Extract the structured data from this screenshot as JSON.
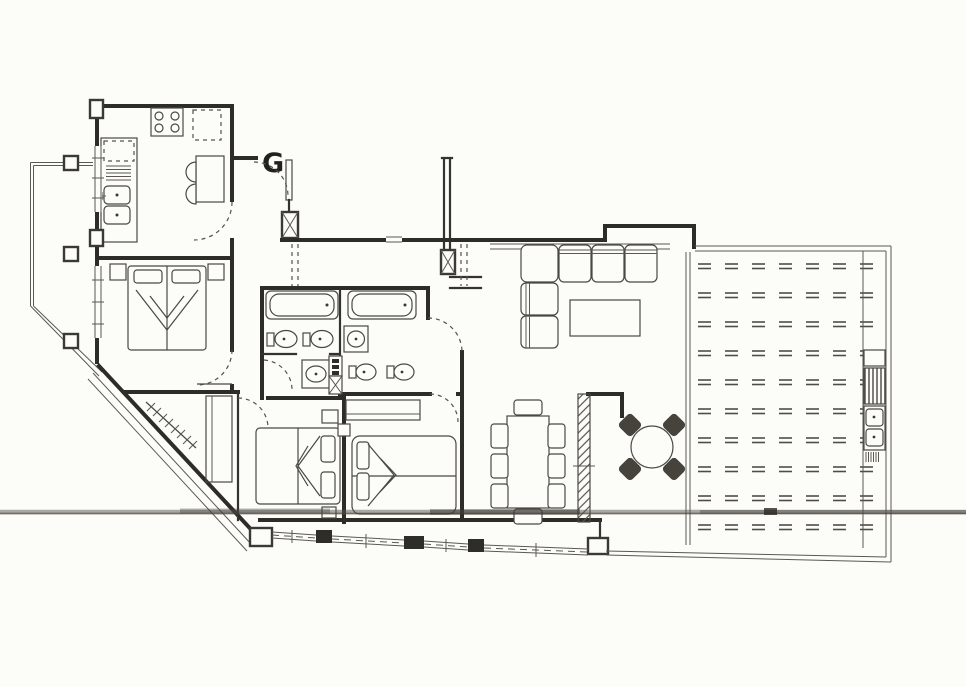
{
  "plan": {
    "unit_label": "G",
    "type": "scanned-apartment-floor-plan",
    "rooms": [
      "kitchen",
      "entrance-hall",
      "bedroom-1",
      "bathroom-1",
      "bathroom-2",
      "bedroom-2",
      "bedroom-3",
      "living-room",
      "dining-area",
      "patio-nook",
      "terrace",
      "west-balcony"
    ],
    "fixtures": {
      "kitchen": [
        "stove",
        "refrigerator",
        "double-sink",
        "counter",
        "breakfast-table",
        "two-chairs"
      ],
      "entrance-hall": [
        "entry-door",
        "coat-rack",
        "wardrobe",
        "duct-column"
      ],
      "bedroom-1": [
        "double-bed",
        "nightstand",
        "nightstand"
      ],
      "bathroom-1": [
        "bathtub",
        "bidet",
        "toilet",
        "washbasin",
        "duct-shaft"
      ],
      "bathroom-2": [
        "bathtub",
        "washbasin",
        "bidet",
        "toilet"
      ],
      "bedroom-2": [
        "double-bed",
        "nightstand",
        "nightstand"
      ],
      "bedroom-3": [
        "double-bed",
        "wardrobe",
        "nightstand"
      ],
      "living-room": [
        "corner-sofa",
        "coffee-table"
      ],
      "dining-area": [
        "dining-table",
        "eight-chairs"
      ],
      "patio-nook": [
        "round-table",
        "four-chairs"
      ],
      "terrace": [
        "barbecue",
        "outdoor-double-sink",
        "dash-paving"
      ]
    }
  },
  "colors": {
    "paper": "#fcfcf9",
    "ink": "#3a3933",
    "wall": "#2d2c27",
    "smudge": "#55514a"
  }
}
